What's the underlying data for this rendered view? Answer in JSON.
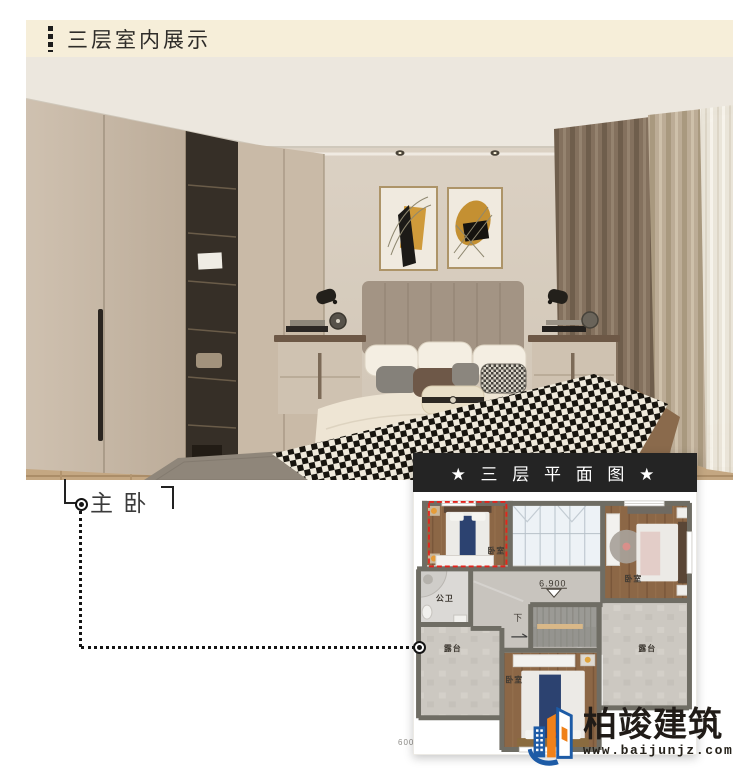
{
  "header": {
    "title": "三层室内展示"
  },
  "callout": {
    "label": "主 卧"
  },
  "plan": {
    "title": "★ 三 层 平 面 图 ★",
    "elevation": "6.900",
    "stair_direction": "下",
    "partial_elevation": "600",
    "labels": {
      "master": "卧室",
      "bedroom2": "卧室",
      "bedroom3": "卧室",
      "bathroom": "公卫",
      "terrace_left": "露台",
      "terrace_right": "露台"
    }
  },
  "logo": {
    "name": "柏竣建筑",
    "website": "www.baijunjz.com"
  },
  "colors": {
    "header_bg": "#f6eed9",
    "highlight_red": "#e3241d",
    "plan_bar_bg": "#242424",
    "logo_blue": "#1d5ba6",
    "logo_orange": "#f08119"
  }
}
